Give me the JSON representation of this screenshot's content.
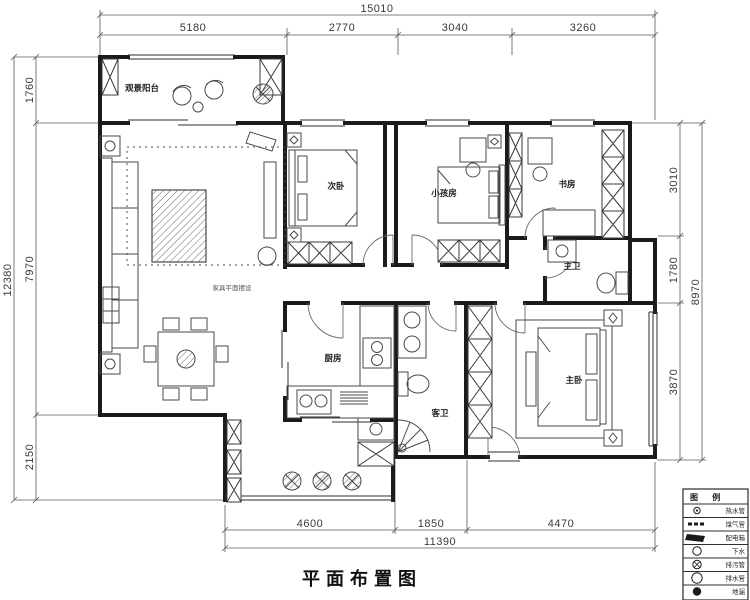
{
  "title": "平面布置图",
  "note": "家具平面摆设",
  "dimensions": {
    "top": {
      "total": "15010",
      "seg1": "5180",
      "seg2": "2770",
      "seg3": "3040",
      "seg4": "3260"
    },
    "left": {
      "total": "12380",
      "seg1": "1760",
      "seg2": "7970",
      "seg3": "2150"
    },
    "right": {
      "total": "8970",
      "seg1": "3010",
      "seg2": "1780",
      "seg3": "3870"
    },
    "bottom": {
      "total": "11390",
      "seg1": "4600",
      "seg2": "1850",
      "seg3": "4470"
    }
  },
  "rooms": {
    "balcony": "观景阳台",
    "bedroom2": "次卧",
    "kids": "小孩房",
    "study": "书房",
    "masterBath": "主卫",
    "kitchen": "厨房",
    "guestBath": "客卫",
    "master": "主卧"
  },
  "legend": {
    "header": "图 例",
    "items": [
      {
        "icon": "hot-water-pipe",
        "label": "热水管"
      },
      {
        "icon": "gas-pipe",
        "label": "煤气管"
      },
      {
        "icon": "distribution-box",
        "label": "配电箱"
      },
      {
        "icon": "drain",
        "label": "下水"
      },
      {
        "icon": "sewage-pipe",
        "label": "排污管"
      },
      {
        "icon": "drain-pipe",
        "label": "排水管"
      },
      {
        "icon": "floor-drain",
        "label": "地漏"
      }
    ]
  }
}
